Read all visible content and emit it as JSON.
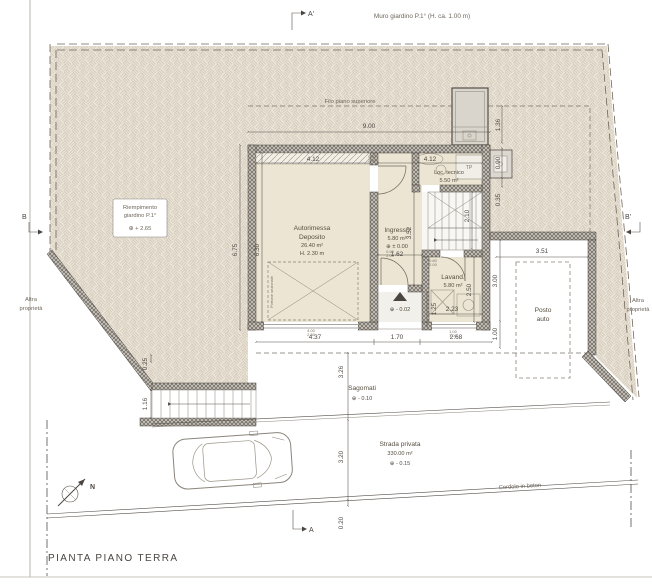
{
  "title": "PIANTA PIANO TERRA",
  "markers": {
    "top": "A'",
    "bottom": "A",
    "left": "B",
    "right": "B'",
    "north": "N"
  },
  "site": {
    "muro_giardino": "Muro giardino P.1° (H. ca. 1.00 m)",
    "filo": "Filo piano superiore",
    "riempimento1": "Riempimento",
    "riempimento2": "giardino P.1°",
    "riempimento_level": "⊕ + 2.65",
    "altra_left1": "Altra",
    "altra_left2": "proprietà",
    "altra_right1": "Altra",
    "altra_right2": "proprietà",
    "sagomati": "Sagomati",
    "sagomati_level": "⊕ - 0.10",
    "strada": "Strada privata",
    "strada_area": "330.00 m²",
    "strada_level": "⊕ - 0.15",
    "cordolo": "Cordolo in beton",
    "posto1": "Posto",
    "posto2": "auto"
  },
  "rooms": {
    "autorimessa1": "Autorimessa",
    "autorimessa2": "Deposito",
    "autorimessa_area": "26.40 m²",
    "autorimessa_h": "H. 2.30 m",
    "portone": "Portone sezionale",
    "ingresso": "Ingresso",
    "ingresso_area": "5.80 m²",
    "ingresso_level": "⊕ ± 0.00",
    "loctec": "Loc. tecnico",
    "loctec_area": "5.50 m²",
    "lavanderia": "Lavand.",
    "lavanderia_area": "5.80 m²",
    "porch_level": "⊕ - 0.02",
    "tp": "TP"
  },
  "dims": {
    "total_w": "9.00",
    "garage_top": "4.12",
    "loctec_top": "4.12",
    "right_a": "1.36",
    "right_b": "0.90",
    "right_c": "0.35",
    "left_outer": "6.75",
    "left_inner": "6.30",
    "ingresso_w": "1.62",
    "ingresso_l": "3.52",
    "stairs_l": "2.10",
    "lavand_w": "2.23",
    "lavand_l": "2.50",
    "porch_l": "1.25",
    "front_a": "4.37",
    "front_b": "1.70",
    "front_c": "2.68",
    "court_a": "3.00",
    "court_b": "1.00",
    "posto_w": "3.51",
    "sago_d": "3.26",
    "road_d": "3.20",
    "curb": "0.20",
    "stair_a": "0.25",
    "stair_b": "1.16"
  },
  "door_labels": {
    "d1": "0.80",
    "d1h": "2.00",
    "d2": "0.90",
    "d2h": "2.00",
    "d3": "0.80",
    "d3h": "2.00",
    "d4": "4.00",
    "d4h": "2.30",
    "d5": "1.00",
    "d5h": "1.00"
  }
}
